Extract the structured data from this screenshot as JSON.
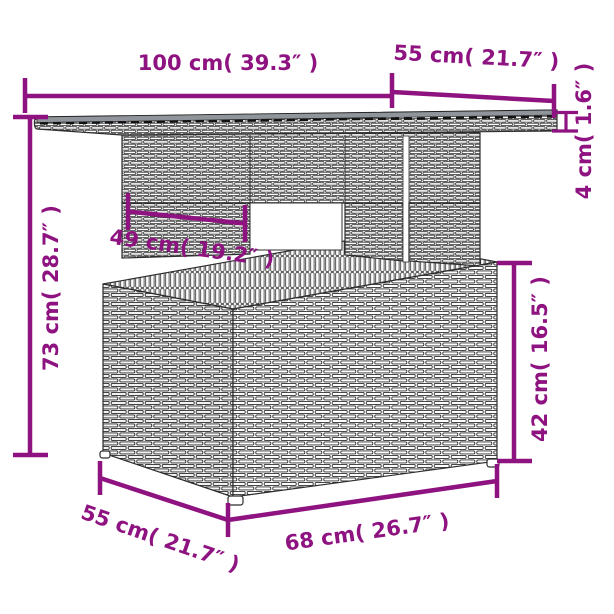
{
  "diagram": {
    "title": "Poly rattan garden table dimension drawing",
    "style": {
      "accent_color": "#8e1380",
      "line_color": "#2e2e2e",
      "glass_color": "#8f959a",
      "background": "#ffffff"
    },
    "dimensions": {
      "tabletop_width": {
        "label": "100 cm( 39.3″ )",
        "cm": 100,
        "inches": 39.3
      },
      "tabletop_depth": {
        "label": "55 cm( 21.7″ )",
        "cm": 55,
        "inches": 21.7
      },
      "tabletop_thickness": {
        "label": "4 cm( 1.6″ )",
        "cm": 4,
        "inches": 1.6
      },
      "total_height": {
        "label": "73 cm( 28.7″ )",
        "cm": 73,
        "inches": 28.7
      },
      "pedestal_width": {
        "label": "49 cm( 19.2″ )",
        "cm": 49,
        "inches": 19.2
      },
      "base_height": {
        "label": "42 cm( 16.5″ )",
        "cm": 42,
        "inches": 16.5
      },
      "base_depth": {
        "label": "55 cm( 21.7″ )",
        "cm": 55,
        "inches": 21.7
      },
      "base_width": {
        "label": "68 cm( 26.7″ )",
        "cm": 68,
        "inches": 26.7
      }
    }
  }
}
